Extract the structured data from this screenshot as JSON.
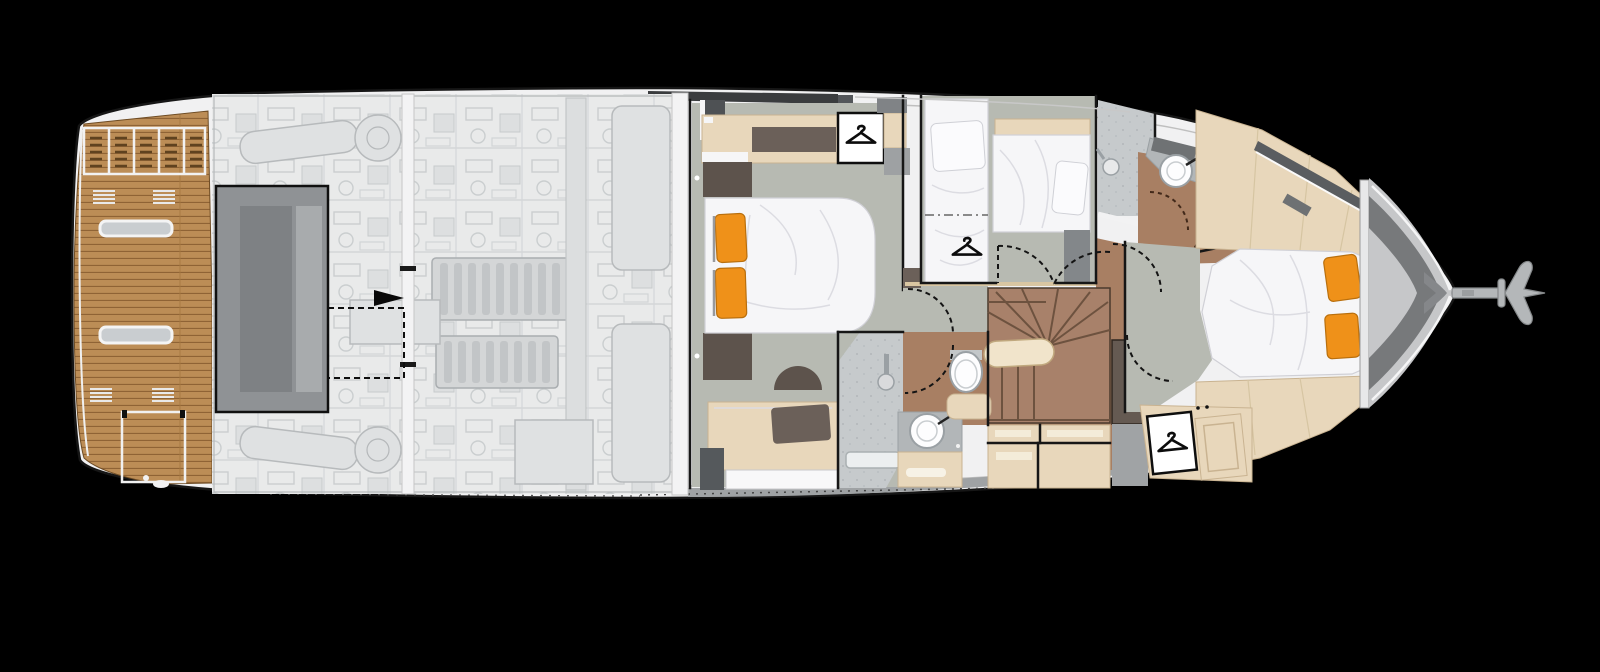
{
  "document": {
    "kind": "yacht-lower-deck-floor-plan",
    "visible_text": "none"
  },
  "palette": {
    "bg": "#000000",
    "hull_white": "#f1f1f2",
    "outline": "#161616",
    "teak": "#bc8d55",
    "teak_line": "#8f6335",
    "deck_dark": "#8f9295",
    "engine_bg": "#e9eaea",
    "engine_line": "#b7babc",
    "floor_gray": "#b7bab2",
    "wood_floor": "#a87f63",
    "stair_wood": "#a8816a",
    "furn_wood": "#e8d7bb",
    "furn_wood_edge": "#c9b391",
    "cushion_brown": "#6b6059",
    "dark_unit": "#55595c",
    "bed_white": "#f6f6f8",
    "pillow_orange": "#ef9119",
    "pillow_edge": "#b96f0d",
    "tile_gray": "#c6cacc",
    "counter_gray": "#b2b6b8",
    "fixture_white": "#fdfdfe",
    "fixture_stroke": "#9aa0a4",
    "bow_gray": "#c6c7c9",
    "bow_dark": "#77797b",
    "anchor_gray": "#b4b7b9",
    "glazing_dark": "#3a3c3e",
    "hatch_gray": "#c9cdd0",
    "hanger_black": "#0c0c0c",
    "handrail_cream": "#f1e4cb"
  },
  "icons": [
    {
      "name": "hanger-icon",
      "location": "aft-cabin-wardrobe"
    },
    {
      "name": "hanger-icon",
      "location": "guest-cabin"
    },
    {
      "name": "hanger-icon",
      "location": "forward-cabin-closet"
    },
    {
      "name": "direction-arrow-icon",
      "location": "cockpit-hatch"
    },
    {
      "name": "anchor-icon",
      "location": "bow"
    }
  ],
  "regions": [
    "swim-platform",
    "cockpit-hatch",
    "engine-room",
    "aft-cabin",
    "aft-head",
    "guest-cabin",
    "mid-shower",
    "forward-head",
    "staircase",
    "forward-cabin",
    "bow-locker",
    "anchor"
  ]
}
